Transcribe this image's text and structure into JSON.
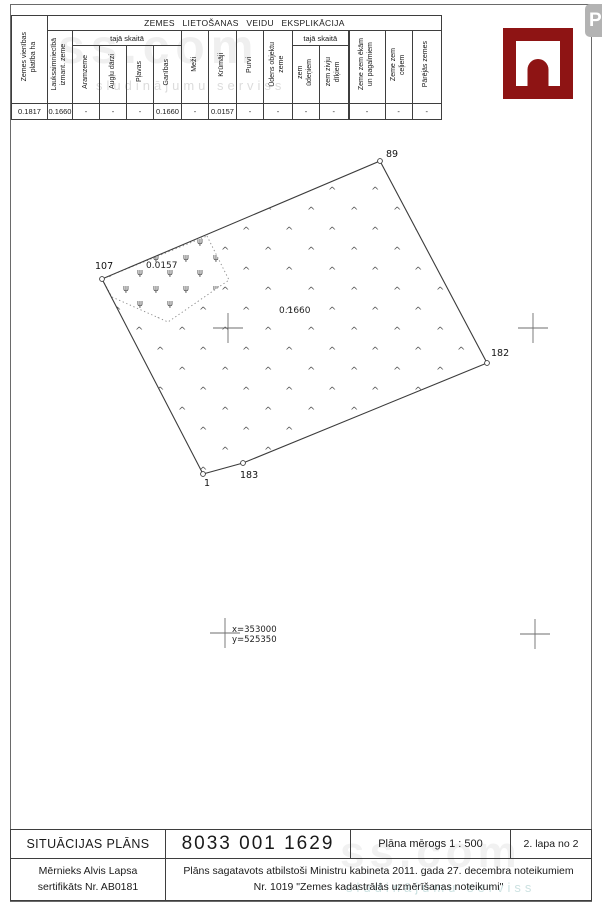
{
  "explication_table": {
    "title": "ZEMES LIETOŠANAS VEIDU EKSPLIKĀCIJA",
    "subgroup1_label": "tajā skaitā",
    "subgroup2_label": "tajā skaitā",
    "headers": {
      "area_total": "Zemes vienības\nplatība ha",
      "agricultural": "Lauksaimniecībā\nizmant. zeme",
      "arable": "Aramzeme",
      "orchards": "Augļu dārzi",
      "meadows": "Pļavas",
      "pastures": "Ganības",
      "forests": "Meži",
      "shrubs": "Krūmāji",
      "swamps": "Purvi",
      "water_objects": "Ūdens objektu\nzeme",
      "under_water": "zem\nūdeņiem",
      "under_fish_ponds": "zem zivju\ndīķiem",
      "under_buildings": "Zeme zem ēkām\nun pagalmiem",
      "under_roads": "Zeme zem\nceļiem",
      "other_land": "Pārējās zemes"
    },
    "values": [
      "0.1817",
      "0.1660",
      "-",
      "-",
      "-",
      "0.1660",
      "-",
      "0.0157",
      "-",
      "-",
      "-",
      "-",
      "-",
      "-",
      "-"
    ]
  },
  "map": {
    "point_labels": {
      "p89": "89",
      "p107": "107",
      "p182": "182",
      "p183": "183",
      "p1": "1"
    },
    "area_labels": {
      "shrub_area": "0.0157",
      "pasture_area": "0.1660"
    },
    "grid_coords": {
      "x": "x=353000",
      "y": "y=525350"
    },
    "symbols": {
      "pasture_glyph": "^",
      "shrub_glyph": "ψ"
    }
  },
  "footer": {
    "doc_type": "SITUĀCIJAS PLĀNS",
    "cadastre_number": "8033 001 1629",
    "scale": "Plāna mērogs 1 : 500",
    "page_indicator": "2. lapa no 2",
    "surveyor": "Mērnieks Alvis Lapsa\nsertifikāts Nr. AB0181",
    "regulation_note": "Plāns sagatavots atbilstoši Ministru kabineta 2011. gada 27. decembra noteikumiem\nNr. 1019 \"Zemes kadastrālās uzmērīšanas noteikumi\""
  },
  "watermark": {
    "brand": "ss.com",
    "tagline": "sludinājumu serviss",
    "badge": "P"
  },
  "colors": {
    "logo_red": "#8e1414"
  }
}
